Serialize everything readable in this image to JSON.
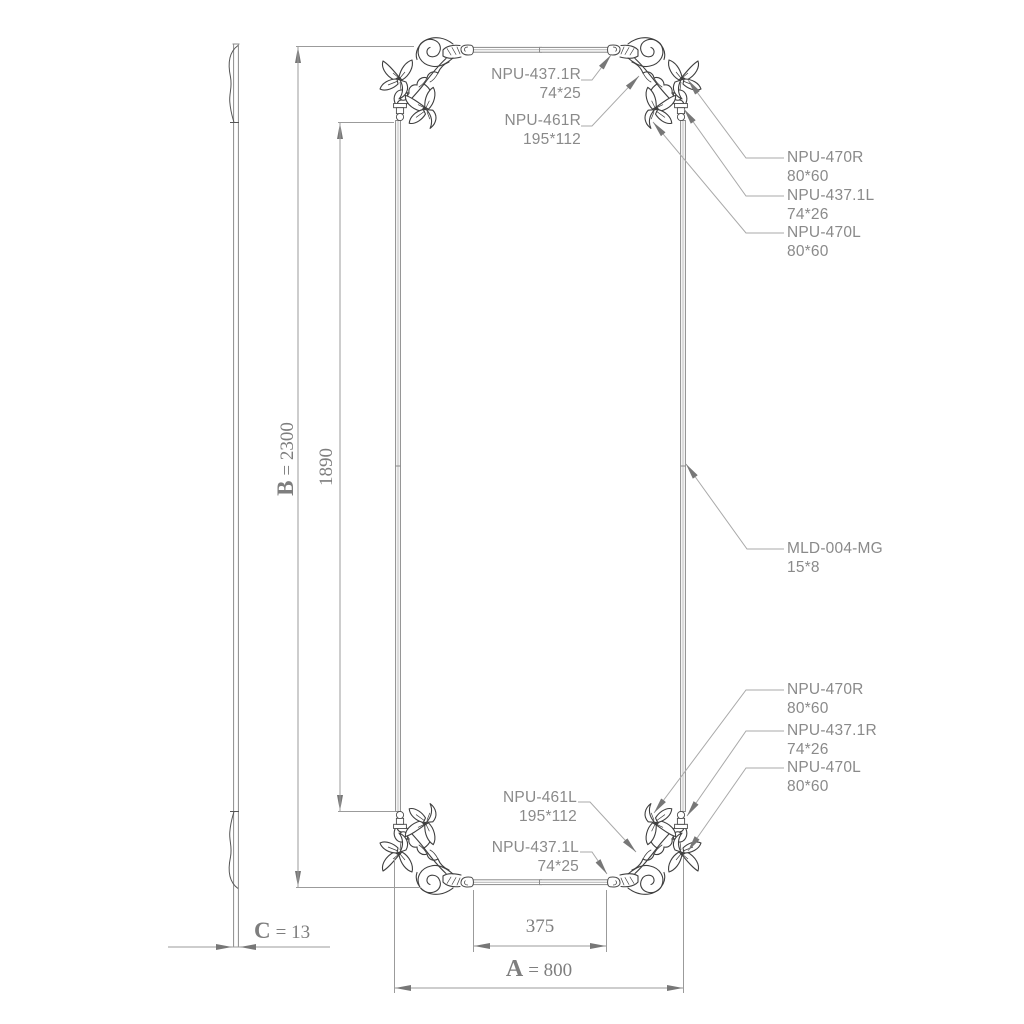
{
  "drawing_type": "furniture-panel-technical-drawing",
  "colors": {
    "background": "#ffffff",
    "line_gray": "#9b9b9b",
    "frame_gray": "#8b8b8b",
    "ornament_dark": "#3f3f3f",
    "callout_text": "#8a8a8a",
    "dimension_text": "#7e7e7e",
    "arrow_fill": "#777777"
  },
  "dimensions": {
    "overall_height": {
      "letter": "B",
      "value": "= 2300"
    },
    "molding_height": {
      "value": "1890"
    },
    "thickness": {
      "letter": "C",
      "value": "= 13"
    },
    "bottom_molding_width": {
      "value": "375"
    },
    "overall_width": {
      "letter": "A",
      "value": "= 800"
    }
  },
  "callouts": {
    "top": [
      {
        "part": "NPU-437.1R",
        "size": "74*25"
      },
      {
        "part": "NPU-461R",
        "size": "195*112"
      }
    ],
    "upper_right": [
      {
        "part": "NPU-470R",
        "size": "80*60"
      },
      {
        "part": "NPU-437.1L",
        "size": "74*26"
      },
      {
        "part": "NPU-470L",
        "size": "80*60"
      }
    ],
    "middle_right": [
      {
        "part": "MLD-004-MG",
        "size": "15*8"
      }
    ],
    "lower_right": [
      {
        "part": "NPU-470R",
        "size": "80*60"
      },
      {
        "part": "NPU-437.1R",
        "size": "74*26"
      },
      {
        "part": "NPU-470L",
        "size": "80*60"
      }
    ],
    "bottom": [
      {
        "part": "NPU-461L",
        "size": "195*112"
      },
      {
        "part": "NPU-437.1L",
        "size": "74*25"
      }
    ]
  }
}
